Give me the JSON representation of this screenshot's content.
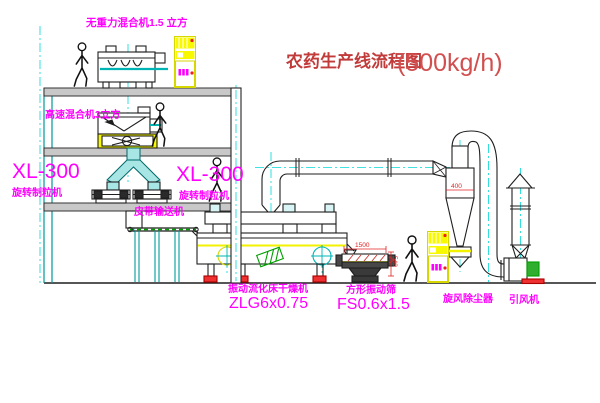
{
  "title": {
    "text": "农药生产线流程图",
    "capacity": "(500kg/h)",
    "color": "#c23b3b",
    "capacity_color": "#d14f4f"
  },
  "equipment_labels": {
    "gravity_mixer": "无重力混合机1.5 立方",
    "high_speed_mixer": "高速混合机3立方",
    "granulator_left_model": "XL-300",
    "granulator_left_name": "旋转制粒机",
    "granulator_right_model": "XL-300",
    "granulator_right_name": "旋转制粒机",
    "belt_conveyor": "皮带输送机",
    "dryer_name": "振动流化床干燥机",
    "dryer_model": "ZLG6x0.75",
    "sieve_name": "方形振动筛",
    "sieve_model": "FS0.6x1.5",
    "cyclone_name": "旋风除尘器",
    "fan_name": "引风机"
  },
  "dimensions": {
    "sieve_width": "1500",
    "sieve_height": "540",
    "cyclone_dim": "400"
  },
  "colors": {
    "label_magenta": "#ff00ff",
    "dim_red": "#e02020",
    "cad_cyan": "#00b4b4",
    "line_black": "#1f1f1f",
    "highlight_yellow": "#f2f200",
    "motor_green": "#00a000",
    "foot_red": "#ee3030",
    "floor_gray": "#c8c8c8"
  }
}
